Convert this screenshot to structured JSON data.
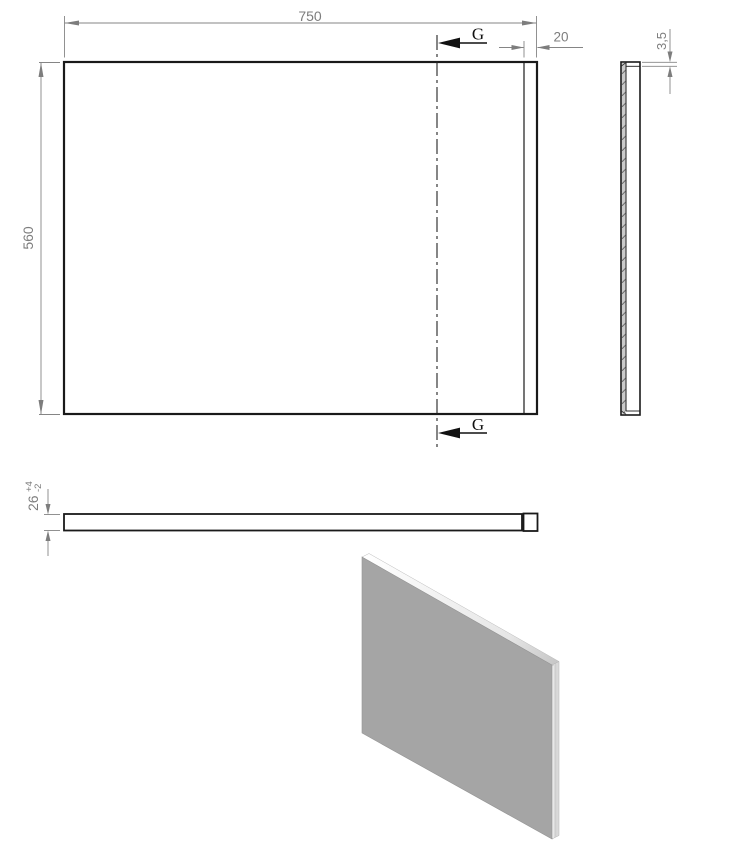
{
  "drawing": {
    "front_view": {
      "width_dim": "750",
      "height_dim": "560",
      "edge_dim": "20",
      "section_label_top": "G",
      "section_label_bottom": "G"
    },
    "side_view": {
      "thickness_dim": "3,5"
    },
    "plan_view": {
      "thickness_dim": "26",
      "tolerance_plus": "+4",
      "tolerance_minus": "-2"
    },
    "iso_view": {
      "face_color": "#a5a5a5",
      "edge_face_color": "#d9d9d9",
      "top_face_start": "#ffffff",
      "top_face_end": "#c6c6c6"
    },
    "colors": {
      "outline": "#1a1a1a",
      "dimension": "#7d7d7d",
      "section": "#111111",
      "background": "#ffffff"
    }
  }
}
